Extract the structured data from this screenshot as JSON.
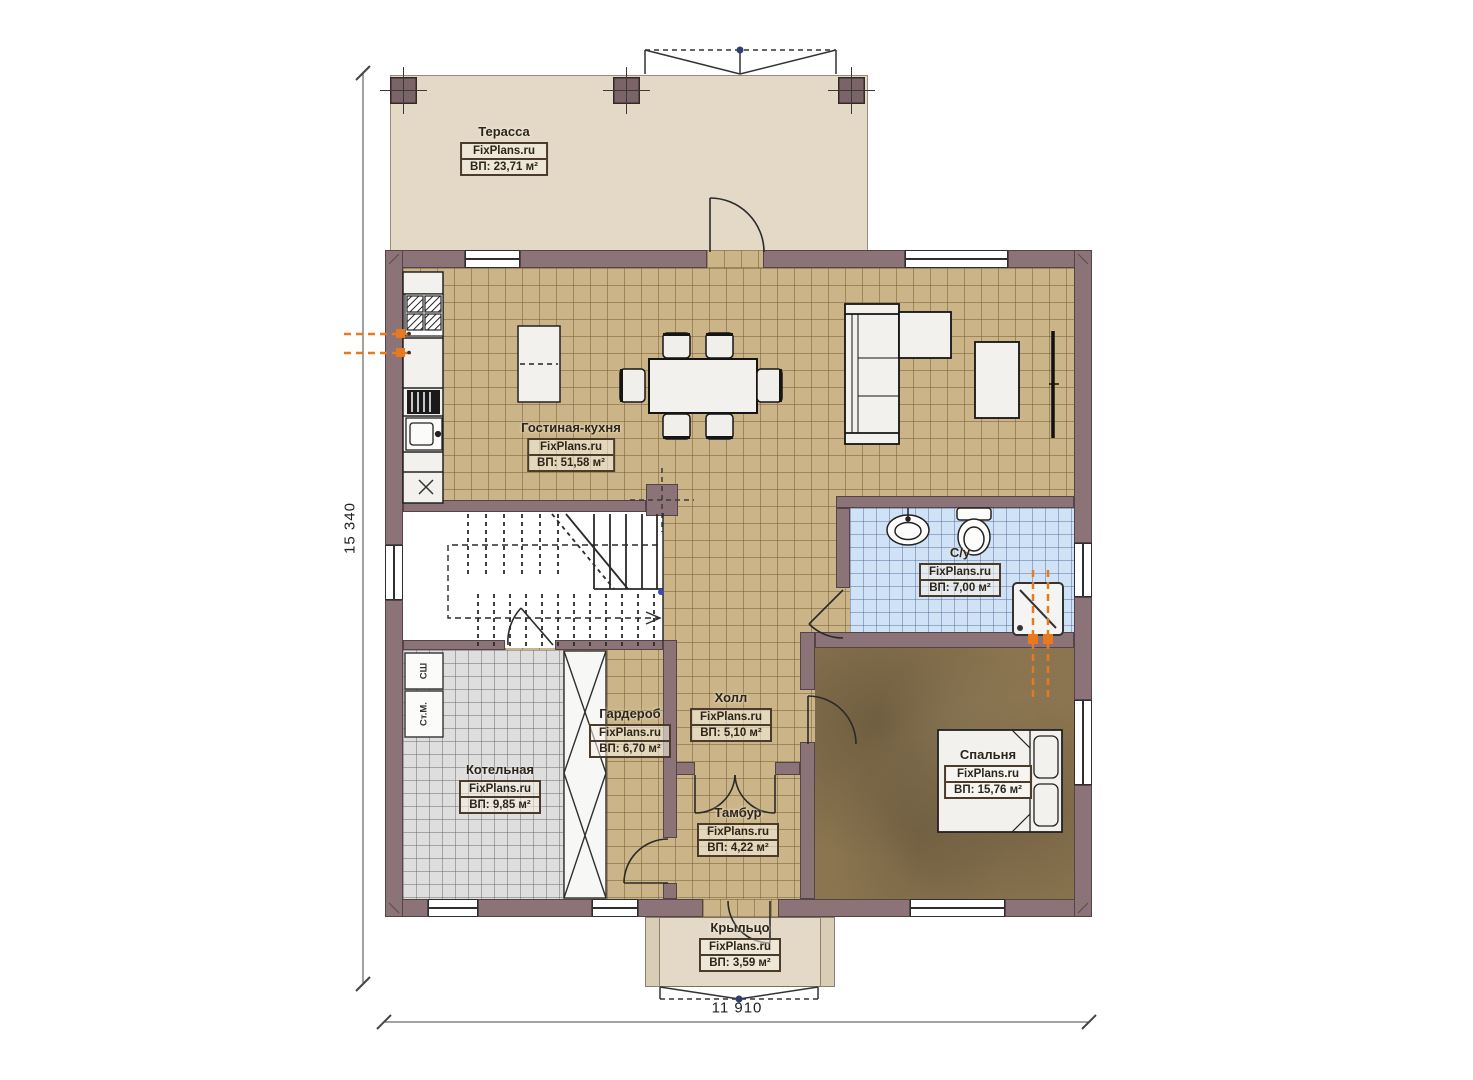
{
  "site": "FixPlans.ru",
  "plan": {
    "width_label": "11 910",
    "height_label": "15 340"
  },
  "rooms": [
    {
      "name": "Терасса",
      "area": "ВП: 23,71 м²"
    },
    {
      "name": "Гостиная-кухня",
      "area": "ВП: 51,58 м²"
    },
    {
      "name": "С/у",
      "area": "ВП: 7,00 м²"
    },
    {
      "name": "Холл",
      "area": "ВП: 5,10 м²"
    },
    {
      "name": "Гардероб",
      "area": "ВП: 6,70 м²"
    },
    {
      "name": "Котельная",
      "area": "ВП: 9,85 м²"
    },
    {
      "name": "Тамбур",
      "area": "ВП: 4,22 м²"
    },
    {
      "name": "Спальня",
      "area": "ВП: 15,76 м²"
    },
    {
      "name": "Крыльцо",
      "area": "ВП: 3,59 м²"
    }
  ],
  "appliances": {
    "dryer": "СШ",
    "washer": "Ст.М."
  },
  "colors": {
    "wall": "#8b7377",
    "floor_tile_tan": "#cbb588",
    "floor_tile_blue": "#cfe2f6",
    "floor_tile_gray": "#dedede",
    "floor_carpet_brown": "#8b7550",
    "terrace_floor": "#e3d9c6",
    "plumbing_orange": "#e8791e"
  }
}
